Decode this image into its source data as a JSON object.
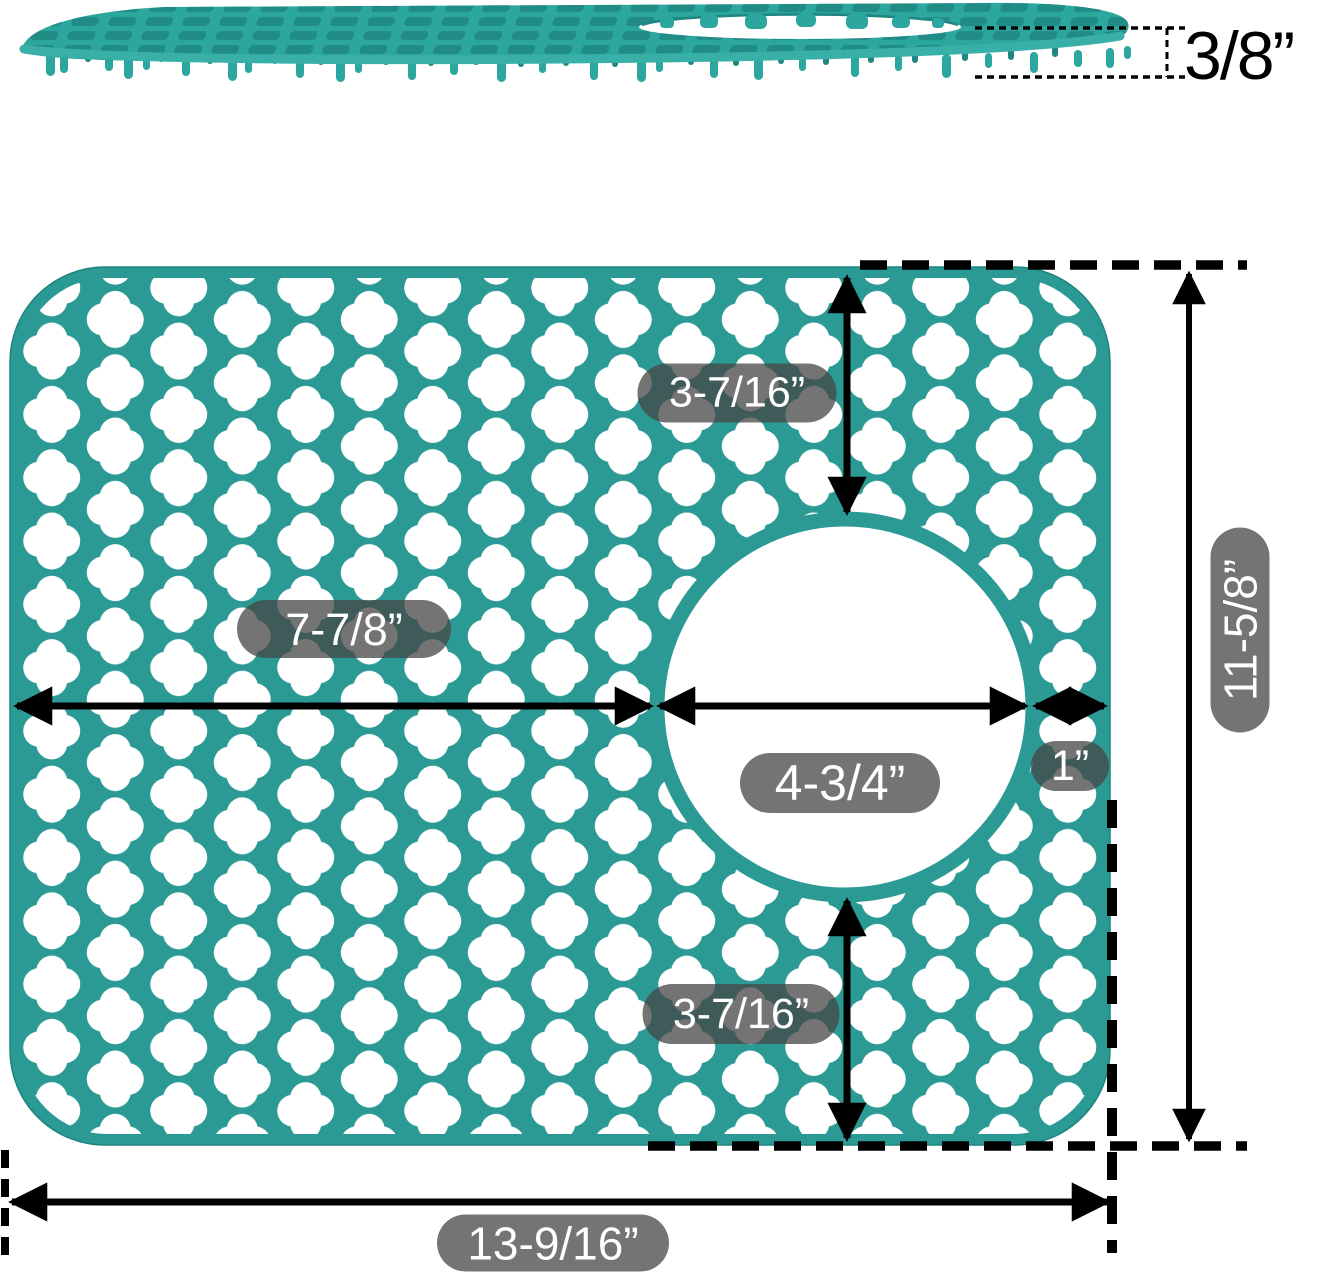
{
  "colors": {
    "mat_teal": "#2C9A94",
    "side_teal": "#2CA79F",
    "side_hole_shadow": "#17756F",
    "side_edge_light": "#38AFA7",
    "back_peg_teal": "#1F8680",
    "dimension_line": "#000000",
    "label_bg": "rgba(70,70,70,0.75)",
    "label_text": "#FFFFFF",
    "hole_white": "#FFFFFF"
  },
  "side_view": {
    "thickness_label": "3/8”"
  },
  "top_view": {
    "labels": {
      "top_gap": "3-7/16”",
      "left_width": "7-7/8”",
      "hole_diameter": "4-3/4”",
      "right_gap": "1”",
      "total_height": "11-5/8”",
      "bottom_gap": "3-7/16”",
      "total_width": "13-9/16”"
    }
  }
}
